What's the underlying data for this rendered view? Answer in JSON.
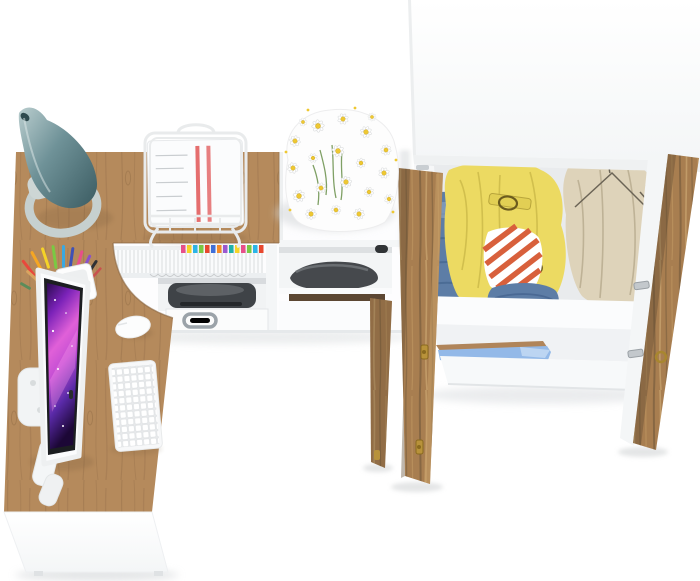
{
  "scene": {
    "title": "Top-down 3D render of white and oak home-office / wardrobe furniture set",
    "view": "top-down product render, no text",
    "background": "#ffffff"
  },
  "colors": {
    "desk_wood": "#b58a5c",
    "desk_wood_edge": "#8a6743",
    "door_wood": "#a87e50",
    "door_wood_dark": "#5f4b33",
    "white_furniture": "#fdfdfe",
    "panel_edge": "#eef0f2",
    "interior_shadow": "#e9ebed",
    "lamp_teal": "#6f9298",
    "lamp_teal_dark": "#3f6066",
    "lamp_base_gray": "#c6d0cf",
    "screen_magenta": "#e060d8",
    "paper_white": "#fbfcfd",
    "paper_red_stripe": "#e05555",
    "flower_yellow": "#eec832",
    "flower_green": "#7fa065",
    "jacket_yellow": "#ecda62",
    "coat_beige": "#ded3ba",
    "denim_blue": "#5d7da6",
    "stripe_red": "#d8603c",
    "shelf_blue": "#93b9e8",
    "brass": "#b8923a",
    "chrome": "#9ba3a9",
    "silver_hinge": "#c3c8cc",
    "printer_dark": "#3f4347",
    "shoe_dark": "#46494d",
    "wood_strip_dark": "#5c4733"
  },
  "pens": {
    "colors": [
      "#e8483c",
      "#f5a623",
      "#f5d327",
      "#7ac943",
      "#3aa8e0",
      "#3f51b5",
      "#e84f8a",
      "#8a52c7",
      "#2f3235",
      "#d9a460",
      "#c9514e",
      "#5b8c5a"
    ]
  },
  "files": {
    "tab_colors": [
      "#e84f8a",
      "#f5d327",
      "#2bb5e8",
      "#7ac943",
      "#e8482f",
      "#3f6fd8",
      "#f58a27",
      "#9b59d0",
      "#20b2aa",
      "#f5d327",
      "#e84f8a",
      "#7ac943",
      "#2bb5e8",
      "#e8482f"
    ]
  },
  "objects": {
    "desk": "L-shaped corner desk, oak top with curved corner cutout, white front panel",
    "lamp": "teal cone desk lamp with loop base on desk corner",
    "monitor": "white all-in-one computer, purple galaxy wallpaper, lying tilted on desk",
    "keyboard": "white keyboard",
    "mouse": "white mouse",
    "pen_cup": "white cup with colored pens and pencils",
    "document_tray": "white wire document tray holding papers with red stripes",
    "storage_unit": "white under-desk shelf: files with colored tabs, printer, drawer with chrome handle, shoe shelves",
    "flowers": "bouquet of white daisies on white cabinet top",
    "wardrobe": "two-door oak wardrobe, doors open, white top panel",
    "clothes": "folded denim stack, yellow belted jacket, red-white striped shirt, folded jeans, beige coat on wire hanger",
    "blue_shelf": "light blue pull-out shelf with oak front edge inside wardrobe base"
  }
}
